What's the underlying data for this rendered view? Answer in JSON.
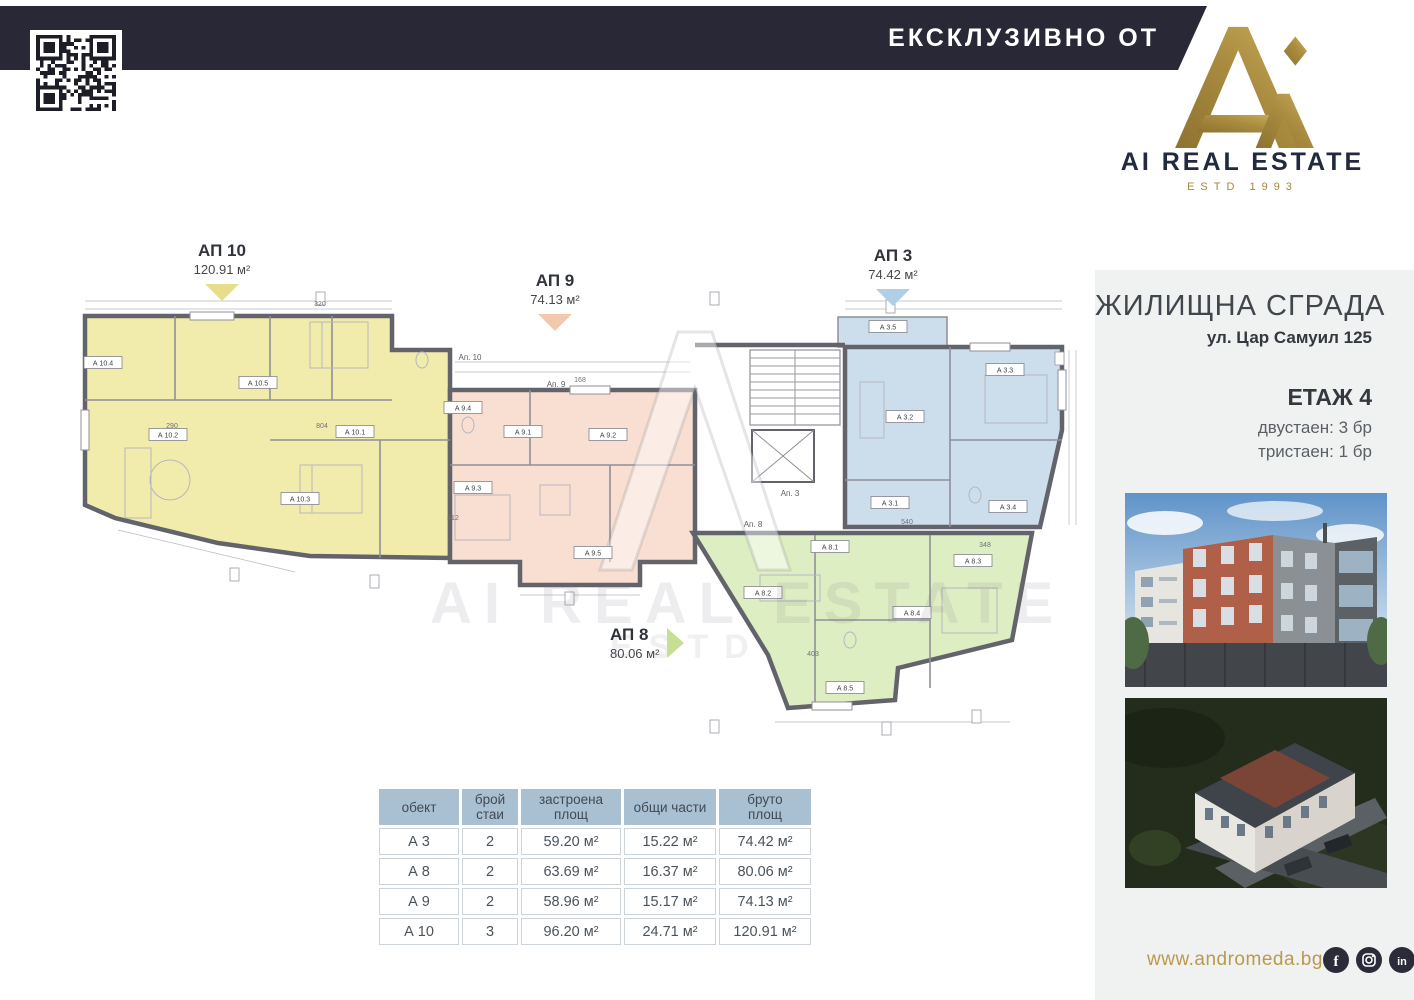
{
  "top_bar": {
    "label": "ЕКСКЛУЗИВНО ОТ",
    "bg": "#282837"
  },
  "logo": {
    "name": "AI REAL ESTATE",
    "estd": "ESTD 1993",
    "gold": "#a6873c",
    "navy": "#222a3e"
  },
  "project": {
    "title": "ЖИЛИЩНА СГРАДА",
    "address": "ул. Цар Самуил 125",
    "floor": "ЕТАЖ 4",
    "unit_mix": [
      "двустаен: 3 бр",
      "тристаен: 1 бр"
    ]
  },
  "floorplan": {
    "apartments": [
      {
        "id": "ap10",
        "callout": "АП 10",
        "area": "120.91 м²",
        "color": "#f2ecac",
        "tri": "#e7dd8b",
        "rooms": [
          "А 10.4",
          "А 10.5",
          "А 10.2",
          "А 10.1",
          "А 10.3"
        ]
      },
      {
        "id": "ap9",
        "callout": "АП 9",
        "area": "74.13 м²",
        "color": "#f8dfd2",
        "tri": "#f3c9ae",
        "rooms": [
          "А 9.4",
          "А 9.1",
          "А 9.2",
          "А 9.3",
          "А 9.5"
        ]
      },
      {
        "id": "ap3",
        "callout": "АП 3",
        "area": "74.42 м²",
        "color": "#ccddeb",
        "tri": "#aecfe5",
        "rooms": [
          "А 3.5",
          "А 3.3",
          "А 3.2",
          "А 3.1",
          "А 3.4"
        ]
      },
      {
        "id": "ap8",
        "callout": "АП 8",
        "area": "80.06 м²",
        "color": "#deeec3",
        "tri": "#c6df92",
        "rooms": [
          "А 8.1",
          "А 8.2",
          "А 8.3",
          "А 8.4",
          "А 8.5"
        ]
      }
    ],
    "corridor_labels": [
      "Ап. 10",
      "Ап. 9",
      "Ап. 3",
      "Ап. 8"
    ],
    "dimensions": [
      "804",
      "290",
      "412",
      "540",
      "348",
      "403",
      "320",
      "168"
    ],
    "watermark": {
      "line1": "AI REAL ESTATE",
      "line2": "ESTD"
    }
  },
  "table": {
    "headers": [
      "обект",
      "брой\nстаи",
      "застроена\nплощ",
      "общи части",
      "бруто\nплощ"
    ],
    "rows": [
      [
        "А 3",
        "2",
        "59.20 м²",
        "15.22 м²",
        "74.42 м²"
      ],
      [
        "А 8",
        "2",
        "63.69 м²",
        "16.37 м²",
        "80.06 м²"
      ],
      [
        "А 9",
        "2",
        "58.96 м²",
        "15.17 м²",
        "74.13 м²"
      ],
      [
        "А 10",
        "3",
        "96.20 м²",
        "24.71 м²",
        "120.91 м²"
      ]
    ]
  },
  "footer": {
    "website": "www.andromeda.bg",
    "social": [
      {
        "name": "facebook",
        "glyph": "f"
      },
      {
        "name": "instagram",
        "glyph": ""
      },
      {
        "name": "linkedin",
        "glyph": "in"
      }
    ]
  }
}
